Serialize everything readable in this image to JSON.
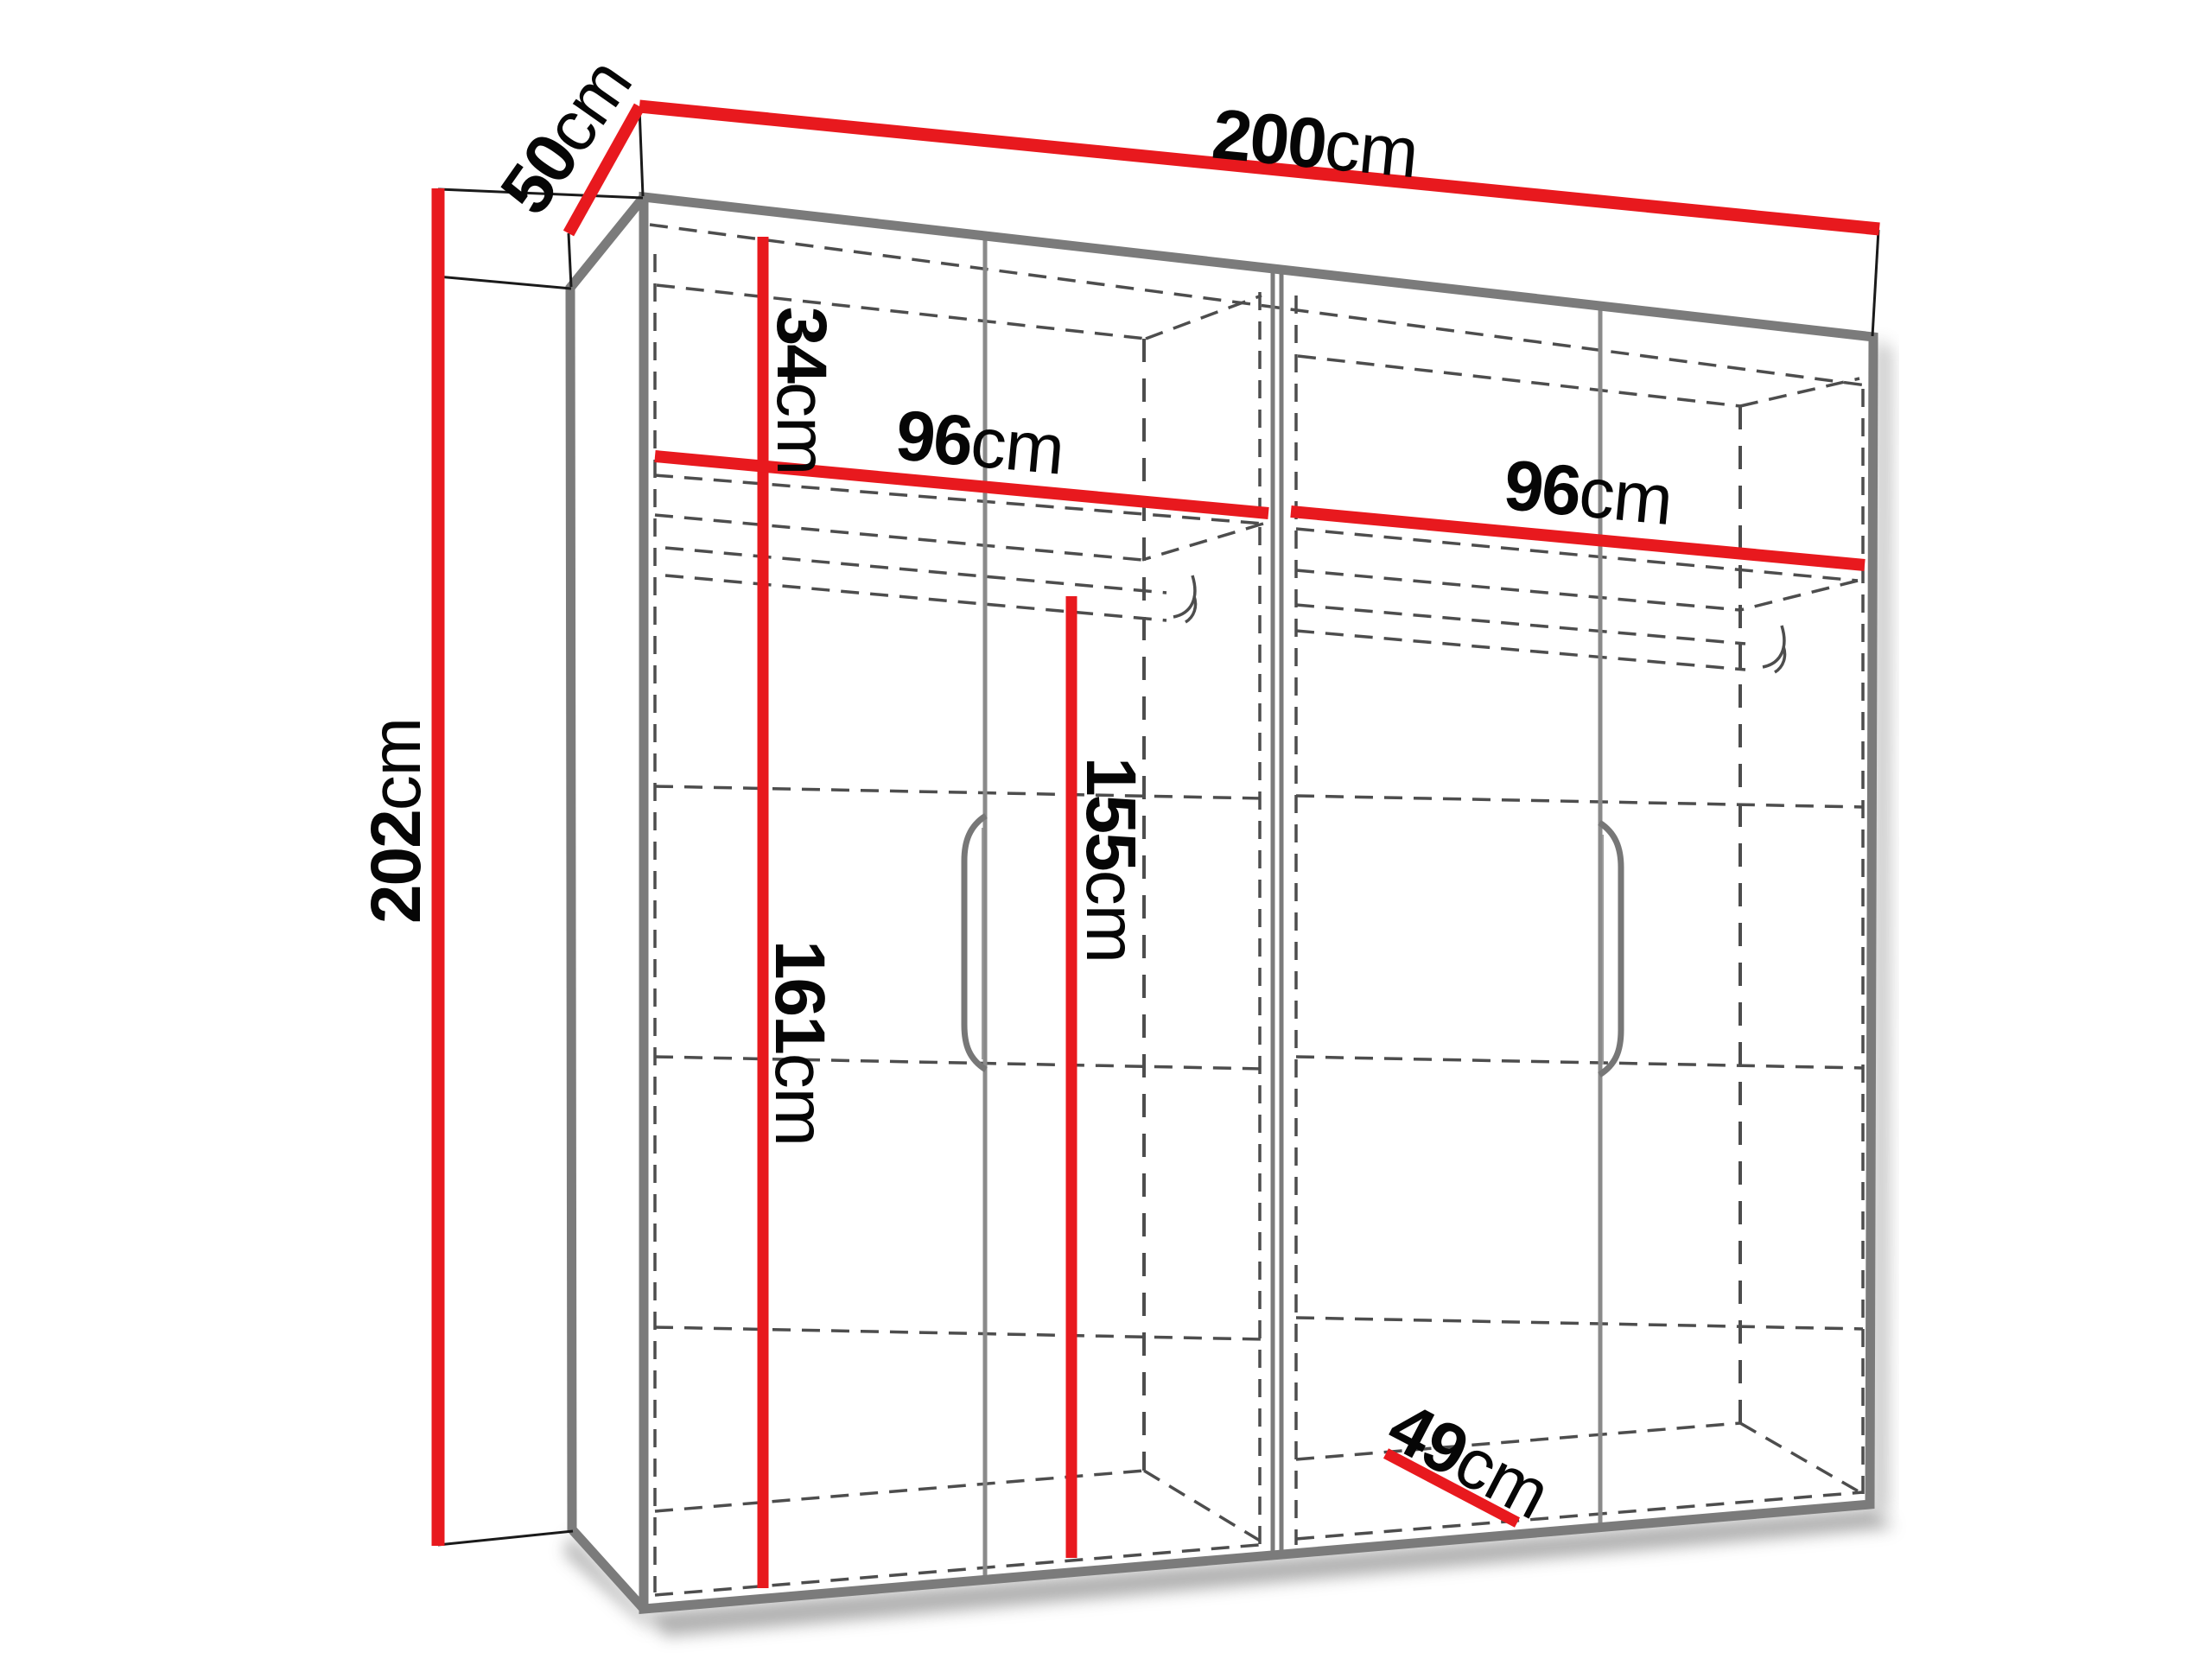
{
  "diagram": {
    "type": "wardrobe-dimension-diagram",
    "description": "3D line drawing of a four-door wardrobe with red dimension lines",
    "colors": {
      "dimension_line": "#e8191e",
      "cabinet_edge": "#7b7b7b",
      "hidden_edge": "#4d4d4d",
      "extension_line": "#1a1a1a",
      "label_text": "#060606",
      "background": "#ffffff"
    },
    "dimensions": {
      "total_width": {
        "value": "200",
        "unit": "cm"
      },
      "total_depth": {
        "value": "50",
        "unit": "cm"
      },
      "total_height": {
        "value": "202",
        "unit": "cm"
      },
      "top_shelf_section_height": {
        "value": "34",
        "unit": "cm"
      },
      "left_section_width": {
        "value": "96",
        "unit": "cm"
      },
      "right_section_width": {
        "value": "96",
        "unit": "cm"
      },
      "hanging_space_height": {
        "value": "155",
        "unit": "cm"
      },
      "lower_interior_height": {
        "value": "161",
        "unit": "cm"
      },
      "interior_depth": {
        "value": "49",
        "unit": "cm"
      }
    }
  }
}
